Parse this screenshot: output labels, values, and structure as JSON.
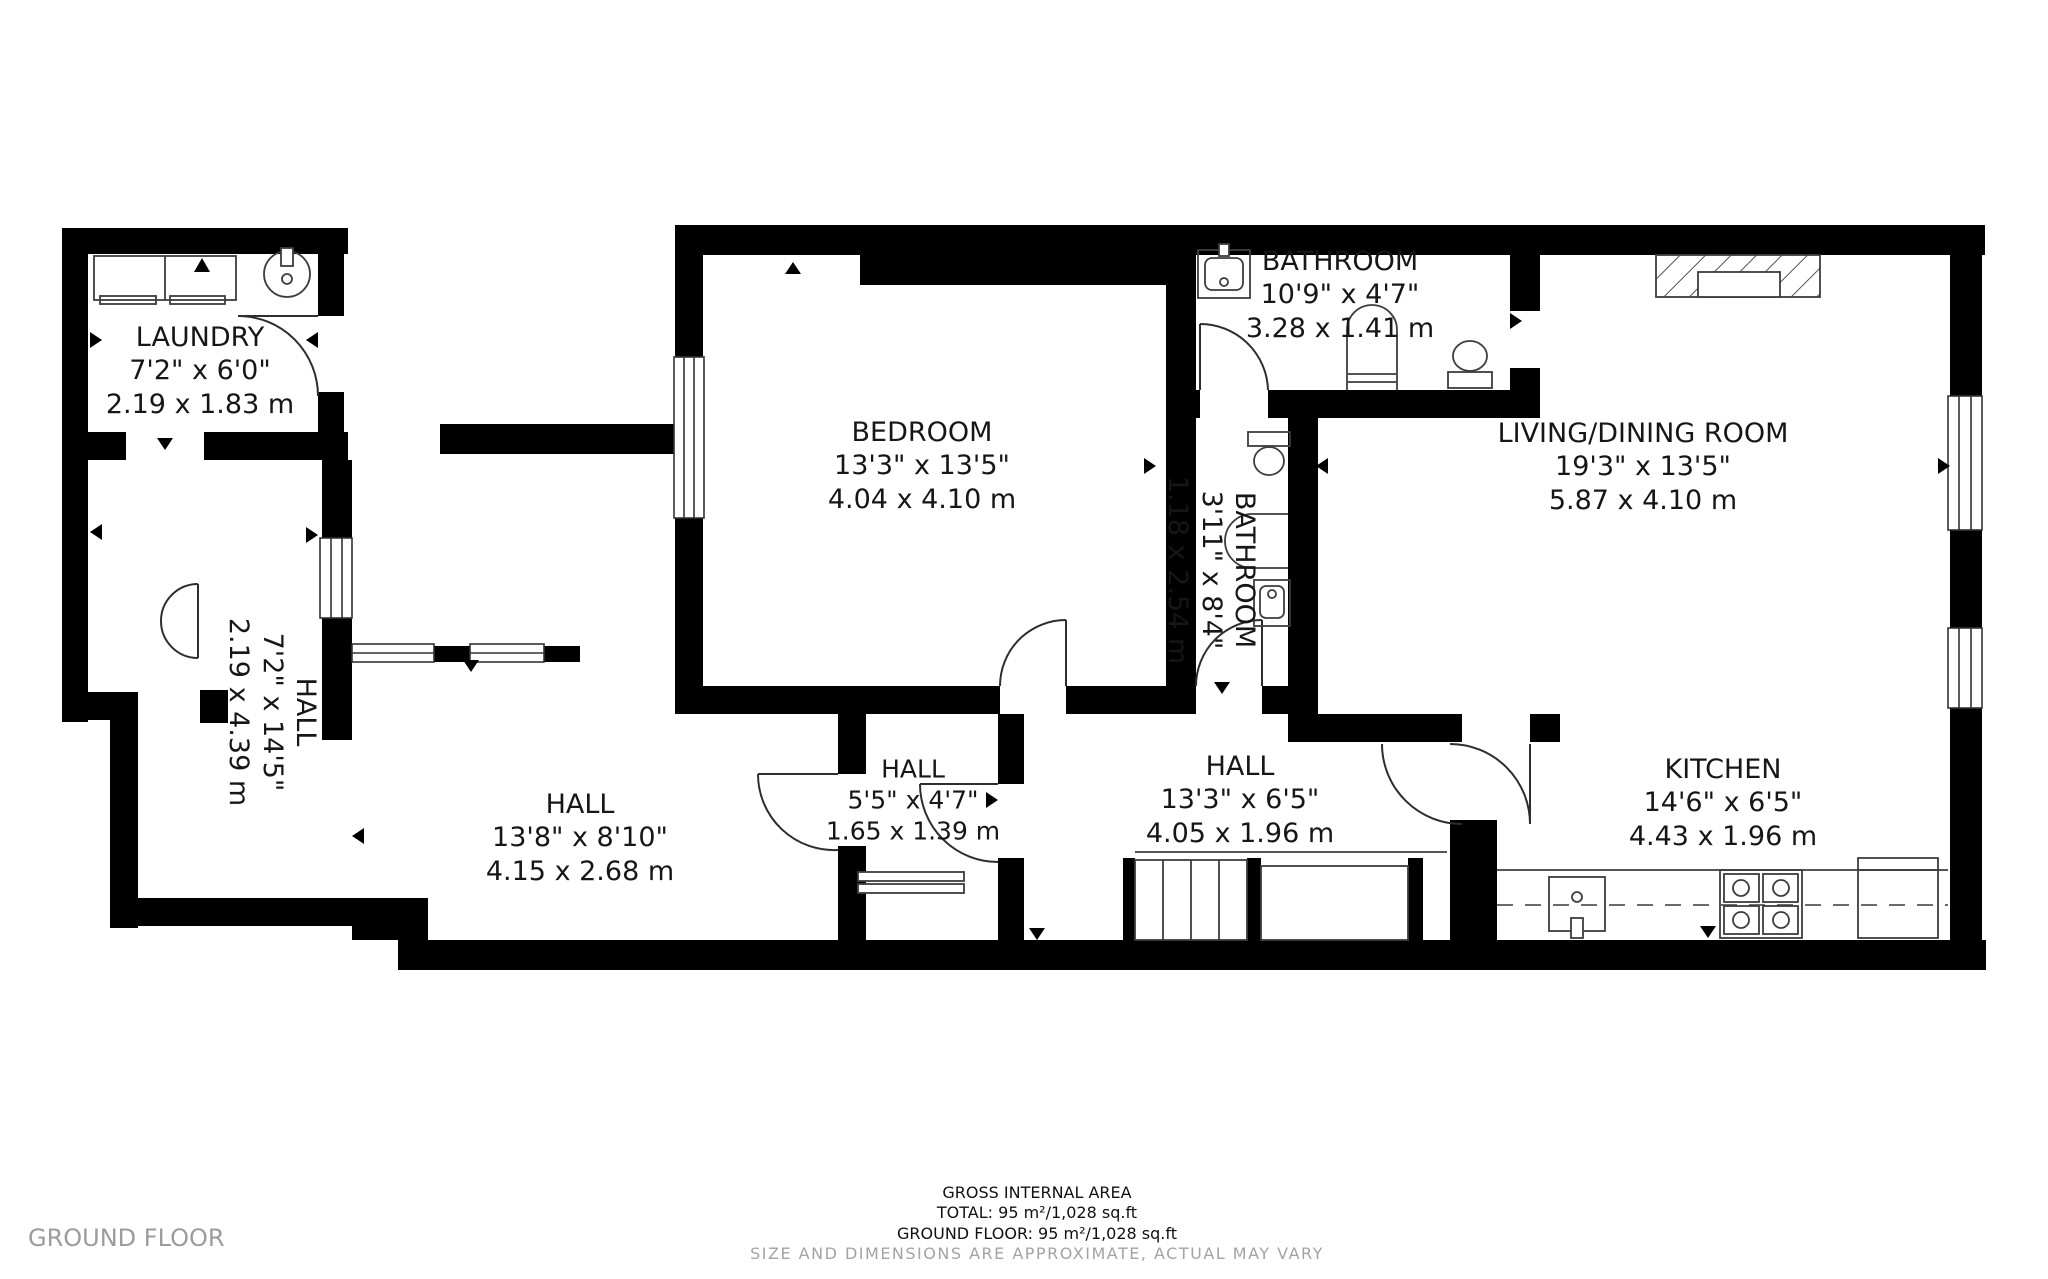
{
  "title": "Ground floor plan",
  "floor_label": "GROUND FLOOR",
  "footer": {
    "heading": "GROSS INTERNAL AREA",
    "total": "TOTAL: 95 m²/1,028 sq.ft",
    "ground_floor": "GROUND FLOOR: 95 m²/1,028 sq.ft",
    "disclaimer": "SIZE AND DIMENSIONS ARE APPROXIMATE, ACTUAL MAY VARY"
  },
  "rooms": {
    "laundry": {
      "name": "LAUNDRY",
      "imperial": "7'2\" x 6'0\"",
      "metric": "2.19 x 1.83 m"
    },
    "hall_west": {
      "name": "HALL",
      "imperial": "7'2\" x 14'5\"",
      "metric": "2.19 x 4.39 m"
    },
    "bedroom": {
      "name": "BEDROOM",
      "imperial": "13'3\" x 13'5\"",
      "metric": "4.04 x 4.10 m"
    },
    "bathroom_top": {
      "name": "BATHROOM",
      "imperial": "10'9\" x 4'7\"",
      "metric": "3.28 x 1.41 m"
    },
    "bathroom_mid": {
      "name": "BATHROOM",
      "imperial": "3'11\" x 8'4\"",
      "metric": "1.18 x 2.54 m"
    },
    "living": {
      "name": "LIVING/DINING ROOM",
      "imperial": "19'3\" x 13'5\"",
      "metric": "5.87 x 4.10 m"
    },
    "hall_main": {
      "name": "HALL",
      "imperial": "13'8\" x 8'10\"",
      "metric": "4.15 x 2.68 m"
    },
    "hall_small": {
      "name": "HALL",
      "imperial": "5'5\" x 4'7\"",
      "metric": "1.65 x 1.39 m"
    },
    "hall_mid": {
      "name": "HALL",
      "imperial": "13'3\" x 6'5\"",
      "metric": "4.05 x 1.96 m"
    },
    "kitchen": {
      "name": "KITCHEN",
      "imperial": "14'6\" x 6'5\"",
      "metric": "4.43 x 1.96 m"
    }
  },
  "fixtures": {
    "laundry": [
      "washer-dryer-units",
      "round-sink"
    ],
    "bathroom_top": [
      "washbasin",
      "bathtub",
      "toilet",
      "door-arc"
    ],
    "bathroom_mid": [
      "toilet",
      "shower",
      "washbasin"
    ],
    "living": [
      "fireplace"
    ],
    "kitchen": [
      "sink-unit",
      "stove-4-burner",
      "counter",
      "dashed-worktop-line"
    ],
    "circulation": [
      "staircase",
      "entry-steps",
      "door-arcs",
      "direction-arrows"
    ]
  },
  "colors": {
    "walls": "#000000",
    "fixture_stroke": "#3d3d3d",
    "text": "#161616",
    "muted_text": "#9c9c9c",
    "background": "#ffffff"
  }
}
